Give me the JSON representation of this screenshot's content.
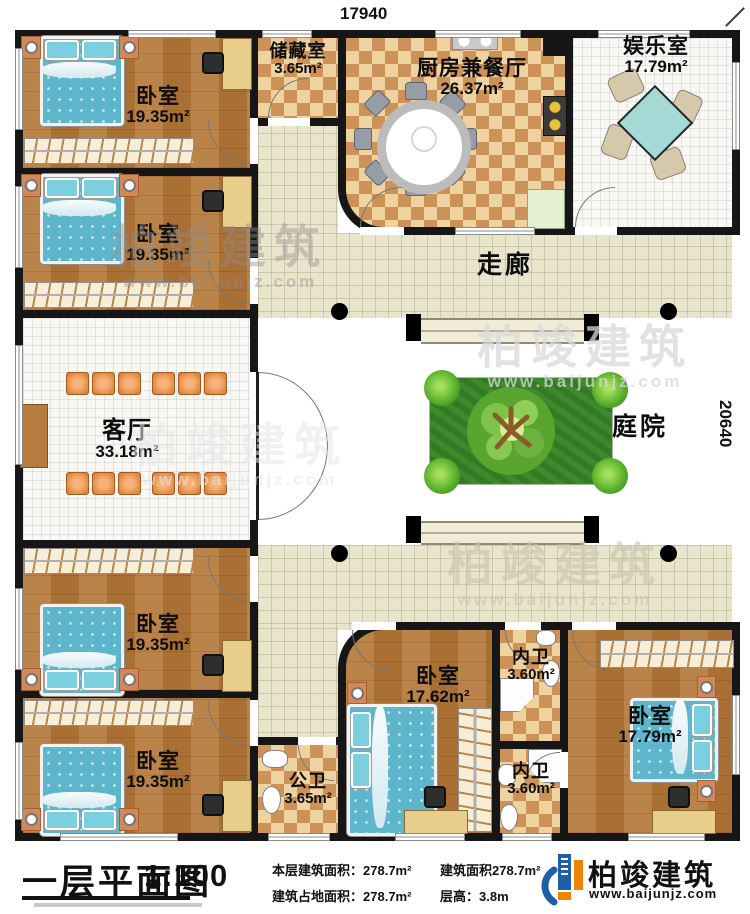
{
  "dimensions": {
    "top": "17940",
    "right": "20640"
  },
  "rooms": {
    "bedroom_tl1": {
      "name": "卧室",
      "area": "19.35m²"
    },
    "bedroom_tl2": {
      "name": "卧室",
      "area": "19.35m²"
    },
    "storage": {
      "name": "储藏室",
      "area": "3.65m²"
    },
    "kitchen_dining": {
      "name": "厨房兼餐厅",
      "area": "26.37m²"
    },
    "entertainment": {
      "name": "娱乐室",
      "area": "17.79m²"
    },
    "corridor": {
      "name": "走廊"
    },
    "living": {
      "name": "客厅",
      "area": "33.18m²"
    },
    "courtyard": {
      "name": "庭院"
    },
    "bedroom_bl1": {
      "name": "卧室",
      "area": "19.35m²"
    },
    "bedroom_bl2": {
      "name": "卧室",
      "area": "19.35m²"
    },
    "public_bath": {
      "name": "公卫",
      "area": "3.65m²"
    },
    "bedroom_bc": {
      "name": "卧室",
      "area": "17.62m²"
    },
    "inner_bath_1": {
      "name": "内卫",
      "area": "3.60m²"
    },
    "inner_bath_2": {
      "name": "内卫",
      "area": "3.60m²"
    },
    "bedroom_br": {
      "name": "卧室",
      "area": "17.79m²"
    }
  },
  "footer": {
    "title": "一层平面图",
    "scale": "1:100",
    "stats": [
      {
        "label": "本层建筑面积：",
        "value": "278.7m²"
      },
      {
        "label": "建筑占地面积：",
        "value": "278.7m²"
      },
      {
        "label": "建筑面积",
        "value": "278.7m²"
      },
      {
        "label": "层高：",
        "value": "3.8m"
      }
    ],
    "brand": {
      "name": "柏竣建筑",
      "url": "www.baijunjz.com"
    }
  },
  "watermark": {
    "name": "柏竣建筑",
    "url": "www.baijunjz.com"
  },
  "colors": {
    "wall": "#161616",
    "wood": "#b07c3f",
    "checker": "#cd9257",
    "tile": "#e9e5cd",
    "garden": "#3c8a2c",
    "brand_blue": "#1e5fa8",
    "brand_orange": "#f08300",
    "bed_blue": "#5db6cc"
  }
}
